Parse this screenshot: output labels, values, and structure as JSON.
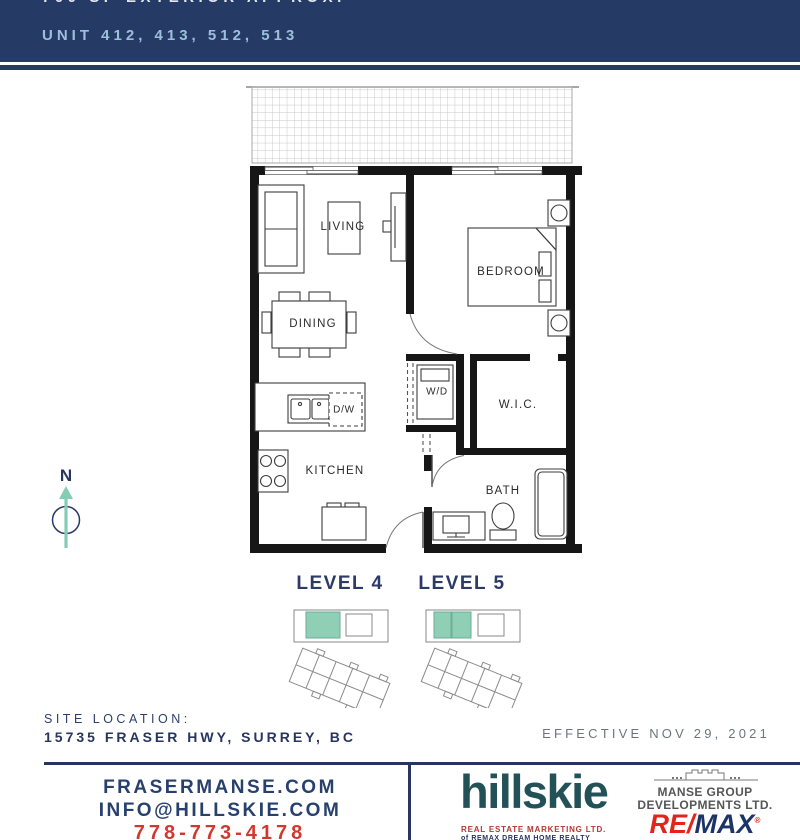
{
  "header": {
    "clipped_line": "700 SF EXTERIOR APPROX.",
    "unit_line": "UNIT 412, 413, 512, 513"
  },
  "plan": {
    "living": "LIVING",
    "bedroom": "BEDROOM",
    "dining": "DINING",
    "washer_dryer": "W/D",
    "walk_in_closet": "W.I.C.",
    "dishwasher": "D/W",
    "kitchen": "KITCHEN",
    "bath": "BATH"
  },
  "compass": {
    "north": "N"
  },
  "levels": [
    {
      "label": "LEVEL 4"
    },
    {
      "label": "LEVEL 5"
    }
  ],
  "site": {
    "label": "SITE LOCATION:",
    "address": "15735 FRASER HWY, SURREY, BC",
    "effective": "EFFECTIVE NOV 29, 2021"
  },
  "footer": {
    "website": "FRASERMANSE.COM",
    "email": "INFO@HILLSKIE.COM",
    "phone": "778-773-4178",
    "brand": "hillskie",
    "brand_line1": "REAL ESTATE MARKETING LTD.",
    "brand_line2": "of REMAX DREAM HOME REALTY",
    "developer_line1": "MANSE GROUP",
    "developer_line2": "DEVELOPMENTS LTD.",
    "remax_re": "RE/",
    "remax_max": "MAX",
    "remax_mark": "®"
  },
  "colors": {
    "navy": "#253a64",
    "light_blue_text": "#9cc0dc",
    "accent_teal": "#8ecfb5",
    "hillskie_teal": "#235158",
    "red": "#d03830",
    "remax_red": "#e1251b",
    "remax_blue": "#1c3568"
  }
}
